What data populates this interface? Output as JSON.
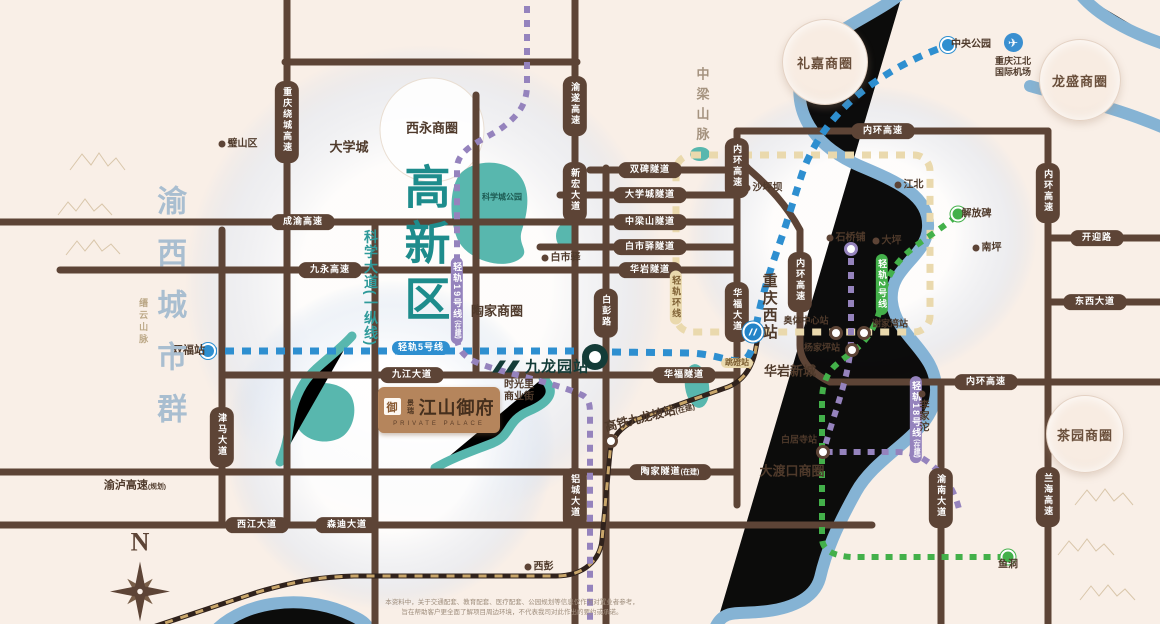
{
  "palette": {
    "bg": "#f9efe7",
    "road": "#5d4436",
    "ink": "#4f3a2b",
    "teal": "#1e8c8c",
    "river": "#7fb0d4",
    "park": "#58b7ae",
    "metro_blue": "#2e8fd0",
    "metro_green": "#43b04a",
    "metro_purple": "#9583bd",
    "metro_tan": "#ead9ad",
    "metro_tan_ink": "#7d5f33",
    "rail": "#30221c",
    "rail_dash": "#c9a66a"
  },
  "project": {
    "seal": "御",
    "brand": "景瑞",
    "name": "江山御府",
    "subtitle": "PRIVATE PALACE"
  },
  "stations": {
    "jiulongyuan": "九龙园站"
  },
  "airport": {
    "line1": "重庆江北",
    "line2": "国际机场"
  },
  "compass": {
    "north": "N"
  },
  "disclaimer": {
    "line1": "本资料中，关于交通配套、教育配套、医疗配套、公园规划等信息仅作为对置业者参考，",
    "line2": "旨在帮助客户更全面了解项目周边环境，不代表我司对此作出的要约或承诺。"
  },
  "items": [
    {
      "k": "pill",
      "t": "重庆绕城高速",
      "x": 287,
      "y": 122,
      "v": 1
    },
    {
      "k": "pill",
      "t": "渝遂高速",
      "x": 575,
      "y": 106,
      "v": 1
    },
    {
      "k": "pill",
      "t": "新宏大道",
      "x": 575,
      "y": 192,
      "v": 1
    },
    {
      "k": "pill",
      "t": "成渝高速",
      "x": 303,
      "y": 222
    },
    {
      "k": "pill",
      "t": "九永高速",
      "x": 330,
      "y": 270
    },
    {
      "k": "pill",
      "t": "双碑隧道",
      "x": 650,
      "y": 170
    },
    {
      "k": "pill",
      "t": "大学城隧道",
      "x": 650,
      "y": 195
    },
    {
      "k": "pill",
      "t": "中梁山隧道",
      "x": 650,
      "y": 222
    },
    {
      "k": "pill",
      "t": "白市驿隧道",
      "x": 650,
      "y": 247
    },
    {
      "k": "pill",
      "t": "华岩隧道",
      "x": 650,
      "y": 270
    },
    {
      "k": "pill",
      "t": "内环高速",
      "x": 883,
      "y": 131
    },
    {
      "k": "pill",
      "t": "内环高速",
      "x": 737,
      "y": 168,
      "v": 1
    },
    {
      "k": "pill",
      "t": "内环高速",
      "x": 800,
      "y": 282,
      "v": 1
    },
    {
      "k": "pill",
      "t": "内环高速",
      "x": 1048,
      "y": 193,
      "v": 1
    },
    {
      "k": "pill",
      "t": "内环高速",
      "x": 986,
      "y": 382
    },
    {
      "k": "pill",
      "t": "开迎路",
      "x": 1097,
      "y": 238
    },
    {
      "k": "pill",
      "t": "东西大道",
      "x": 1095,
      "y": 302
    },
    {
      "k": "pill",
      "t": "华福大道",
      "x": 737,
      "y": 312,
      "v": 1
    },
    {
      "k": "pill",
      "t": "九江大道",
      "x": 412,
      "y": 375
    },
    {
      "k": "pill",
      "t": "华福隧道",
      "x": 684,
      "y": 375
    },
    {
      "k": "pill",
      "t": "津马大道",
      "x": 222,
      "y": 437,
      "v": 1
    },
    {
      "k": "pill",
      "t": "陶家隧道",
      "s": "(在建)",
      "x": 670,
      "y": 472
    },
    {
      "k": "pill",
      "t": "西江大道",
      "x": 257,
      "y": 525
    },
    {
      "k": "pill",
      "t": "森迪大道",
      "x": 347,
      "y": 525
    },
    {
      "k": "pill",
      "t": "白彭路",
      "x": 606,
      "y": 313,
      "v": 1
    },
    {
      "k": "pill",
      "t": "铝城大道",
      "x": 575,
      "y": 498,
      "v": 1
    },
    {
      "k": "pill",
      "t": "渝南大道",
      "x": 941,
      "y": 498,
      "v": 1
    },
    {
      "k": "pill",
      "t": "兰海高速",
      "x": 1048,
      "y": 497,
      "v": 1
    },
    {
      "k": "mpill",
      "c": "blue",
      "t": "轻轨5号线",
      "x": 421,
      "y": 346
    },
    {
      "k": "mpill",
      "c": "tan",
      "t": "轻轨环线",
      "x": 676,
      "y": 300,
      "v": 1
    },
    {
      "k": "mpill",
      "c": "purple",
      "t": "轻轨19号线",
      "s": "(在建)",
      "x": 457,
      "y": 303,
      "v": 1
    },
    {
      "k": "mpill",
      "c": "purple",
      "t": "轻轨18号线",
      "s": "(在建)",
      "x": 916,
      "y": 422,
      "v": 1
    },
    {
      "k": "mpill",
      "c": "green",
      "t": "轻轨2号线",
      "x": 882,
      "y": 287,
      "v": 1
    },
    {
      "k": "mpill",
      "c": "tan",
      "t": "跳磴站",
      "x": 737,
      "y": 361,
      "sm": 1
    },
    {
      "k": "dot",
      "t": "璧山区",
      "x": 222,
      "y": 144
    },
    {
      "k": "dot",
      "t": "白市驿",
      "x": 545,
      "y": 258
    },
    {
      "k": "dot",
      "t": "沙坪坝",
      "x": 747,
      "y": 188
    },
    {
      "k": "dot",
      "t": "江北",
      "x": 898,
      "y": 185
    },
    {
      "k": "dot",
      "t": "石桥铺",
      "x": 830,
      "y": 238
    },
    {
      "k": "dot",
      "t": "大坪",
      "x": 876,
      "y": 241
    },
    {
      "k": "dot",
      "t": "南坪",
      "x": 976,
      "y": 248
    },
    {
      "k": "dot",
      "t": "解放碑",
      "x": 958,
      "y": 214,
      "c": "green"
    },
    {
      "k": "dot",
      "t": "中央公园",
      "x": 948,
      "y": 45,
      "c": "blue"
    },
    {
      "k": "dot",
      "t": "李家沱",
      "x": 922,
      "y": 394,
      "side": "b",
      "vl": 1
    },
    {
      "k": "dot",
      "t": "西彭",
      "x": 528,
      "y": 567
    },
    {
      "k": "dot",
      "t": "鱼洞",
      "x": 1008,
      "y": 557,
      "c": "green",
      "side": "b"
    },
    {
      "k": "dot",
      "t": "双福站",
      "x": 208,
      "y": 351,
      "c": "blue",
      "side": "l",
      "big": 1
    },
    {
      "k": "sta",
      "x": 836,
      "y": 333,
      "t": "奥体中心站",
      "dx": -30,
      "dy": -12
    },
    {
      "k": "sta",
      "x": 864,
      "y": 333,
      "t": "谢家湾站",
      "dx": 26,
      "dy": -9
    },
    {
      "k": "sta",
      "x": 852,
      "y": 350,
      "t": "杨家坪站",
      "dx": -30,
      "dy": -2
    },
    {
      "k": "sta",
      "x": 851,
      "y": 249,
      "rc": "purple"
    },
    {
      "k": "sta",
      "x": 823,
      "y": 452,
      "t": "白居寺站",
      "dx": -24,
      "dy": -12
    },
    {
      "k": "sta",
      "x": 611,
      "y": 441
    },
    {
      "k": "area",
      "t": "礼嘉商圈",
      "x": 825,
      "y": 62,
      "r": 42
    },
    {
      "k": "area",
      "t": "龙盛商圈",
      "x": 1080,
      "y": 80,
      "r": 40
    },
    {
      "k": "area",
      "t": "茶园商圈",
      "x": 1085,
      "y": 434,
      "r": 38
    },
    {
      "k": "txt",
      "t": "西永商圈",
      "x": 432,
      "y": 129,
      "sz": 13
    },
    {
      "k": "txt",
      "t": "陶家商圈",
      "x": 497,
      "y": 312,
      "sz": 13
    },
    {
      "k": "txt",
      "t": "大渡口商圈",
      "x": 792,
      "y": 472,
      "sz": 13
    },
    {
      "k": "txt",
      "t": "华岩新城",
      "x": 790,
      "y": 372,
      "sz": 13
    },
    {
      "k": "txt",
      "t": "大学城",
      "x": 349,
      "y": 148,
      "sz": 13
    },
    {
      "k": "txt",
      "t": "重庆西站",
      "x": 769,
      "y": 307,
      "sz": 15,
      "v": 1,
      "ls": 2
    },
    {
      "k": "txt",
      "t": "高铁九龙坡站",
      "s": "(在建)",
      "x": 650,
      "y": 417,
      "sz": 12,
      "rot": -14
    },
    {
      "k": "txt",
      "t": "中梁山脉",
      "x": 701,
      "y": 107,
      "sz": 13,
      "v": 1,
      "ls": 7,
      "col": "#a5937f"
    },
    {
      "k": "txt",
      "t": "渝西城市群",
      "x": 168,
      "y": 315,
      "sz": 30,
      "v": 1,
      "ls": 22,
      "col": "#a9bed0"
    },
    {
      "k": "txt",
      "t": "缙云山脉",
      "x": 143,
      "y": 322,
      "sz": 9,
      "v": 1,
      "ls": 3,
      "col": "#bca887"
    },
    {
      "k": "txt",
      "t": "高新区",
      "x": 424,
      "y": 247,
      "sz": 46,
      "v": 1,
      "ls": 10,
      "col": "#1e8c8c"
    },
    {
      "k": "txt",
      "t": "科学大道(一纵线)",
      "x": 371,
      "y": 288,
      "sz": 14,
      "v": 1,
      "ls": 1,
      "col": "#2f9a9a"
    },
    {
      "k": "txt",
      "t": "渝泸高速",
      "s": "(规划)",
      "x": 135,
      "y": 486,
      "sz": 11
    },
    {
      "k": "txt",
      "t": "科学城公园",
      "x": 502,
      "y": 197,
      "sz": 8,
      "col": "#1c5a52"
    },
    {
      "k": "txt",
      "t": "时光里\n商业街",
      "x": 519,
      "y": 391,
      "sz": 10
    },
    {
      "k": "bld",
      "x": 548,
      "y": 399
    },
    {
      "k": "poi",
      "t": "重庆医科大学",
      "x": 297,
      "y": 128
    },
    {
      "k": "poi",
      "t": "重庆师范大学",
      "x": 319,
      "y": 173
    },
    {
      "k": "poi",
      "t": "四川美术学院",
      "x": 289,
      "y": 187
    },
    {
      "k": "poi",
      "t": "重庆大学",
      "x": 314,
      "y": 198
    },
    {
      "k": "poi",
      "t": "融创万达茂",
      "x": 402,
      "y": 104,
      "i": "s"
    },
    {
      "k": "poi",
      "t": "沙坪坝实验小学",
      "x": 428,
      "y": 117,
      "tiny": 1
    },
    {
      "k": "poi",
      "t": "陈家桥医院",
      "x": 390,
      "y": 145,
      "i": "c"
    },
    {
      "k": "poi",
      "t": "西永中央商务区",
      "x": 434,
      "y": 152,
      "tiny": 1
    },
    {
      "k": "poi",
      "t": "杨家桥三甲医院",
      "x": 524,
      "y": 207,
      "i": "c"
    },
    {
      "k": "poi",
      "t": "科学城第一中学",
      "x": 464,
      "y": 252,
      "i": "B"
    },
    {
      "k": "poi",
      "t": "重庆市中梁山\n云岭森林公园",
      "x": 678,
      "y": 232,
      "i": "t"
    },
    {
      "k": "poi",
      "t": "重庆市白市驿\n森林公园",
      "x": 595,
      "y": 257,
      "i": "t"
    },
    {
      "k": "poi",
      "t": "石板镇政府",
      "x": 616,
      "y": 298,
      "i": "p"
    },
    {
      "k": "poi",
      "t": "石板中学",
      "x": 617,
      "y": 318
    },
    {
      "k": "poi",
      "t": "西部现代物流园\n(渝新欧铁路起点)",
      "x": 582,
      "y": 151
    },
    {
      "k": "poi",
      "t": "双福时代广场",
      "x": 173,
      "y": 296
    },
    {
      "k": "poi",
      "t": "美利国际\n五金机电城",
      "x": 233,
      "y": 294
    },
    {
      "k": "poi",
      "t": "双福国际农贸城",
      "x": 233,
      "y": 319
    },
    {
      "k": "poi",
      "t": "江津双福\n第二小学",
      "x": 239,
      "y": 341
    },
    {
      "k": "poi",
      "t": "重庆交通大学\n(双福校区)",
      "x": 291,
      "y": 295
    },
    {
      "k": "poi",
      "t": "重庆能源\n职业学院",
      "x": 291,
      "y": 318
    },
    {
      "k": "poi",
      "t": "重庆市双福\n育才中学",
      "x": 291,
      "y": 342
    },
    {
      "k": "poi",
      "t": "巴福小学",
      "x": 336,
      "y": 296
    },
    {
      "k": "poi",
      "t": "巴福中学",
      "x": 336,
      "y": 318
    },
    {
      "k": "poi",
      "t": "江津双福\n体育公园",
      "x": 243,
      "y": 394,
      "i": "t"
    },
    {
      "k": "poi",
      "t": "大岭湖公园",
      "x": 306,
      "y": 407,
      "i": "t"
    },
    {
      "k": "poi",
      "t": "津福中学",
      "x": 306,
      "y": 450
    },
    {
      "k": "poi",
      "t": "重庆工程职业\n技术学院",
      "x": 236,
      "y": 487
    },
    {
      "k": "poi",
      "t": "江津区政府",
      "x": 213,
      "y": 580,
      "i": "p"
    },
    {
      "k": "poi",
      "t": "西南国际塑料城",
      "x": 318,
      "y": 605
    },
    {
      "k": "poi",
      "t": "规划教育用地",
      "x": 392,
      "y": 452,
      "i": "B",
      "big": 1
    },
    {
      "k": "poi",
      "t": "润泽(西南)智惠产业创新城",
      "x": 375,
      "y": 490,
      "i": "S"
    },
    {
      "k": "poi",
      "t": "龙鼎企业中心",
      "x": 498,
      "y": 514
    },
    {
      "k": "poi",
      "t": "陶家生态公园",
      "x": 507,
      "y": 418,
      "i": "t"
    },
    {
      "k": "poi",
      "t": "九龙坡区陶家镇\n人民政府",
      "x": 619,
      "y": 488,
      "i": "p"
    },
    {
      "k": "poi",
      "t": "重庆陶家\n都市工业园",
      "x": 675,
      "y": 490
    },
    {
      "k": "poi",
      "t": "大渡口\n森林公园",
      "x": 692,
      "y": 390,
      "i": "t"
    },
    {
      "k": "poi",
      "t": "巴福九龙西路",
      "x": 612,
      "y": 388,
      "tiny": 1
    },
    {
      "k": "poi",
      "t": "西彭小学",
      "x": 611,
      "y": 403,
      "tiny": 1
    },
    {
      "k": "poi",
      "t": "华福生活广场",
      "x": 758,
      "y": 347,
      "tiny": 1
    },
    {
      "k": "poi",
      "t": "华宇·锦绣广场",
      "x": 758,
      "y": 362,
      "tiny": 1
    },
    {
      "k": "poi",
      "t": "重庆市西区医院",
      "x": 762,
      "y": 386,
      "i": "c"
    },
    {
      "k": "tj",
      "lg": "天街",
      "t": "龙湖U城天街",
      "x": 290,
      "y": 159
    },
    {
      "k": "tj",
      "lg": "天街",
      "t": "高新天街",
      "s": "(在建)",
      "x": 398,
      "y": 166
    }
  ]
}
